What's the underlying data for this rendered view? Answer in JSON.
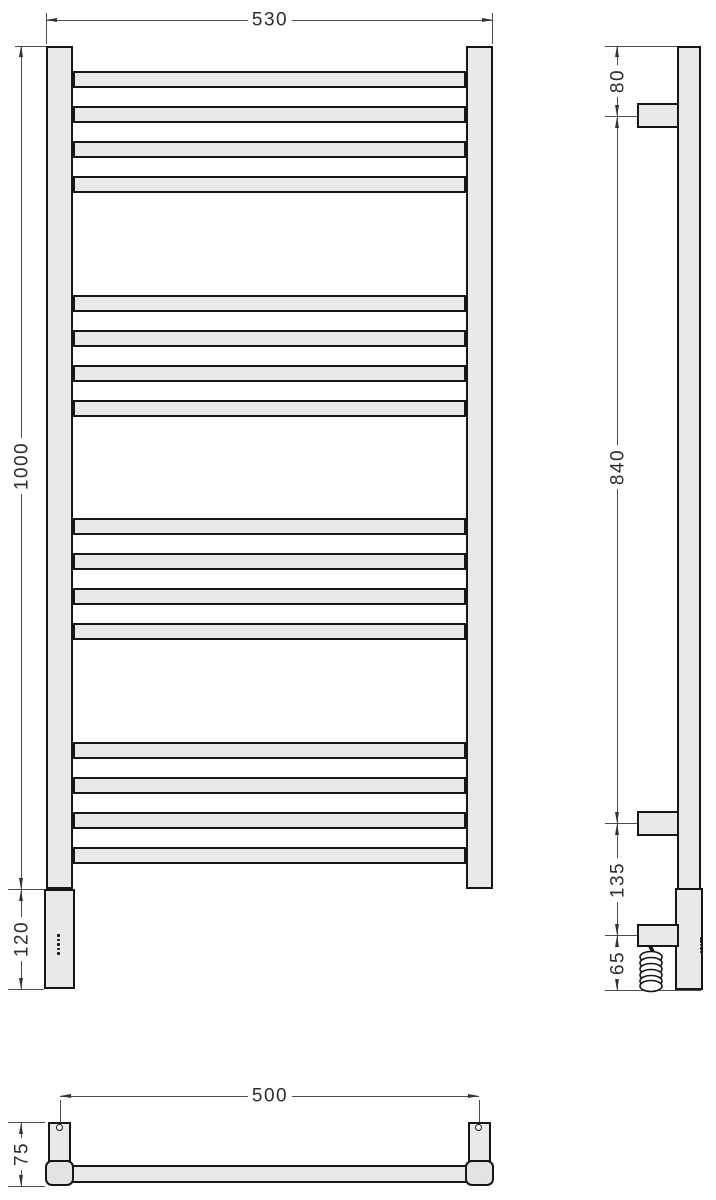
{
  "drawing": {
    "title": "Heated towel rail technical dimension drawing",
    "views": {
      "front": {
        "label": "front-view",
        "rung_groups": 4,
        "rungs_per_group": 4,
        "indicator_dots": 5
      },
      "side": {
        "label": "side-view",
        "wall_brackets": 2,
        "has_spiral_cable": true,
        "indicator_dots": 5
      },
      "bottom": {
        "label": "bottom-view",
        "mount_holes": 2
      }
    },
    "dimensions": {
      "overall_width": {
        "value": "530"
      },
      "overall_height": {
        "value": "1000"
      },
      "panel_height": {
        "value": "120"
      },
      "top_to_upper_bracket": {
        "value": "80"
      },
      "bracket_spacing": {
        "value": "840"
      },
      "bracket_to_box": {
        "value": "135"
      },
      "box_to_bottom": {
        "value": "65"
      },
      "mount_hole_spacing": {
        "value": "500"
      },
      "wall_depth": {
        "value": "75"
      }
    },
    "colors": {
      "fill": "#e9e9e9",
      "outline": "#161616",
      "dimension_line": "#4d4d4d",
      "text": "#2e2e2e"
    }
  }
}
